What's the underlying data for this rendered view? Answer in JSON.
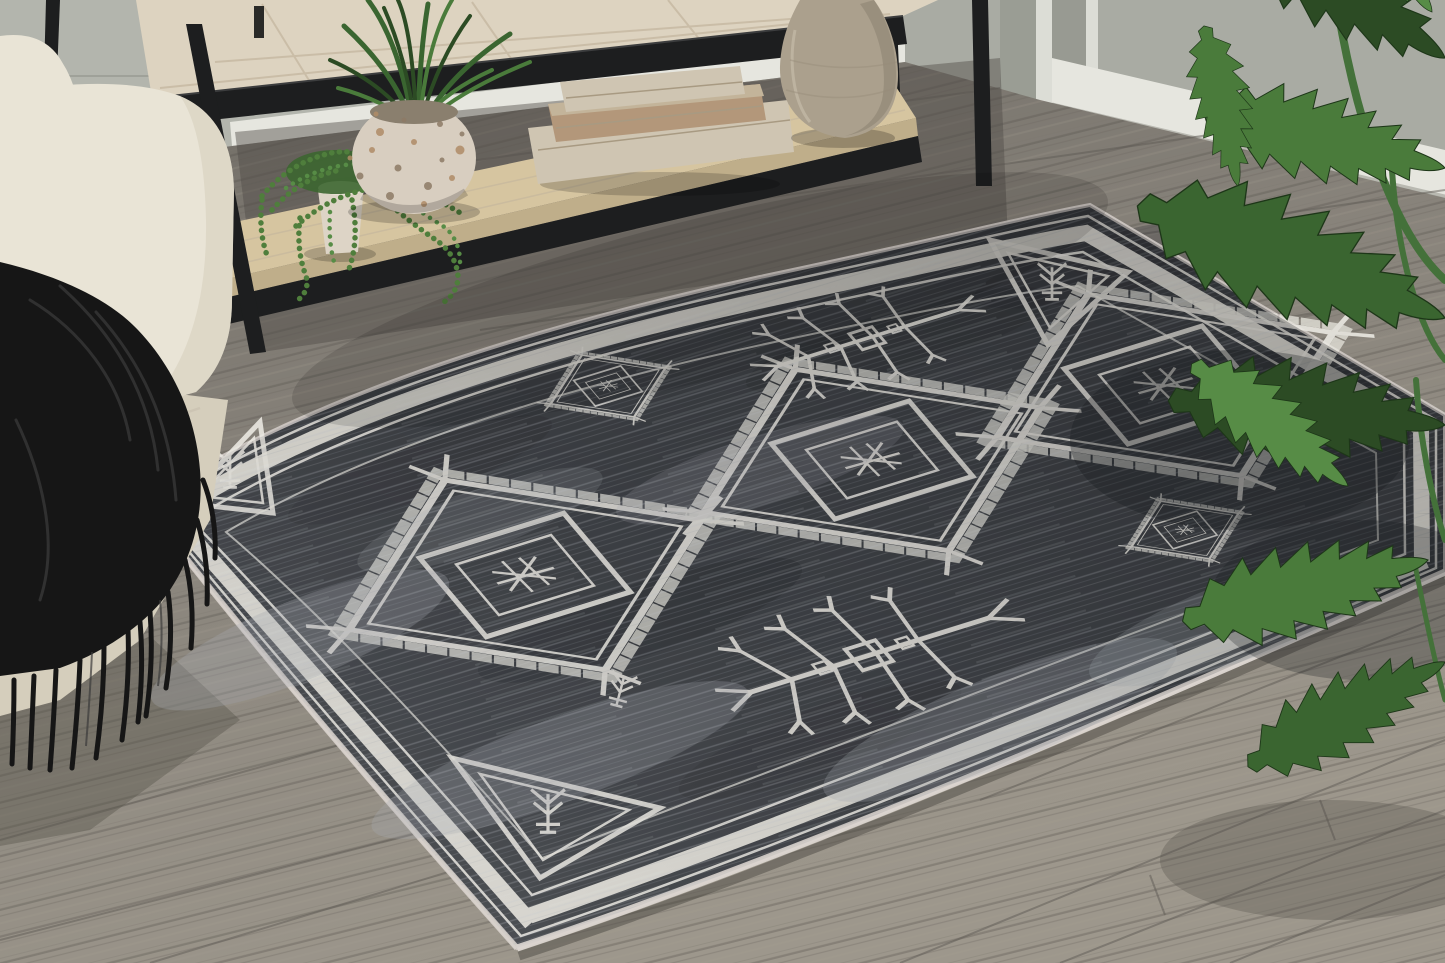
{
  "meta": {
    "title": "Living room lifestyle photo of a tribal-motif area rug",
    "width": 1445,
    "height": 963
  },
  "scene": {
    "description": "Lifestyle photo: a distressed charcoal-gray area rug with ivory tribal geometric medallions, corner triangles and a checkered diamond border lies on a gray wood-plank floor. A cream sofa with a black fringed throw sits at left; behind it a whitewashed console table with a black metal frame holds a speckled pot with a grassy plant, a trailing string-of-pearls succulent, a stack of decorative book boxes and a large stoneware vase. Split-leaf philodendron foliage hangs over the right side.",
    "objects": [
      {
        "name": "area-rug",
        "label": "Charcoal tribal rug with ivory medallions and checkered border"
      },
      {
        "name": "sofa",
        "label": "Cream upholstered sofa arm"
      },
      {
        "name": "throw-blanket",
        "label": "Black fringed throw blanket"
      },
      {
        "name": "console-table",
        "label": "Whitewashed wood console table with black metal frame"
      },
      {
        "name": "terrazzo-pot-plant",
        "label": "Speckled round pot with grassy green plant"
      },
      {
        "name": "string-of-pearls",
        "label": "Trailing string-of-pearls succulent in a small pot"
      },
      {
        "name": "book-boxes",
        "label": "Stack of three decorative book boxes"
      },
      {
        "name": "vase",
        "label": "Large stoneware vase"
      },
      {
        "name": "philodendron",
        "label": "Split-leaf philodendron foliage"
      },
      {
        "name": "floor",
        "label": "Gray wood plank floor"
      },
      {
        "name": "wall",
        "label": "Gray wall with white baseboard and door casing"
      }
    ]
  },
  "palette": {
    "wall": "#a9aba3",
    "wall_left": "#b3b5ad",
    "wall_side": "#989a92",
    "baseboard": "#e6e6df",
    "trim": "#dcddd6",
    "floor": "#87827a",
    "floor_dark": "#6e6a63",
    "floor_light": "#9d978c",
    "seam": "#5f5b55",
    "rug": "#3f4247",
    "rug_dark": "#2e3034",
    "heather": "#a8acb2",
    "motif": "#eae8e1",
    "binding": "#d0cac5",
    "sofa": "#e9e4d6",
    "sofa_dark": "#d5cebc",
    "throw": "#161616",
    "throw_hi": "#4b4b4b",
    "metal": "#1d1e1f",
    "wood_top": "#ddd3c0",
    "wood_grain": "#c2b49c",
    "shelf": "#d6c5a0",
    "shelf_edge": "#bfae8a",
    "book1": "#cfc5b2",
    "book2": "#c3b49a",
    "book_wood": "#b3977a",
    "vase": "#aba08d",
    "vase_dark": "#8e8473",
    "pot": "#d8cec0",
    "speck1": "#b08c67",
    "speck2": "#8e7b66",
    "pearl": "#4f7e3c",
    "pearl_dark": "#3c6630",
    "leaf1": "#2c4b24",
    "leaf2": "#3a6530",
    "leaf3": "#4a7b3b",
    "leaf4": "#578c46",
    "stem": "#44713a"
  }
}
